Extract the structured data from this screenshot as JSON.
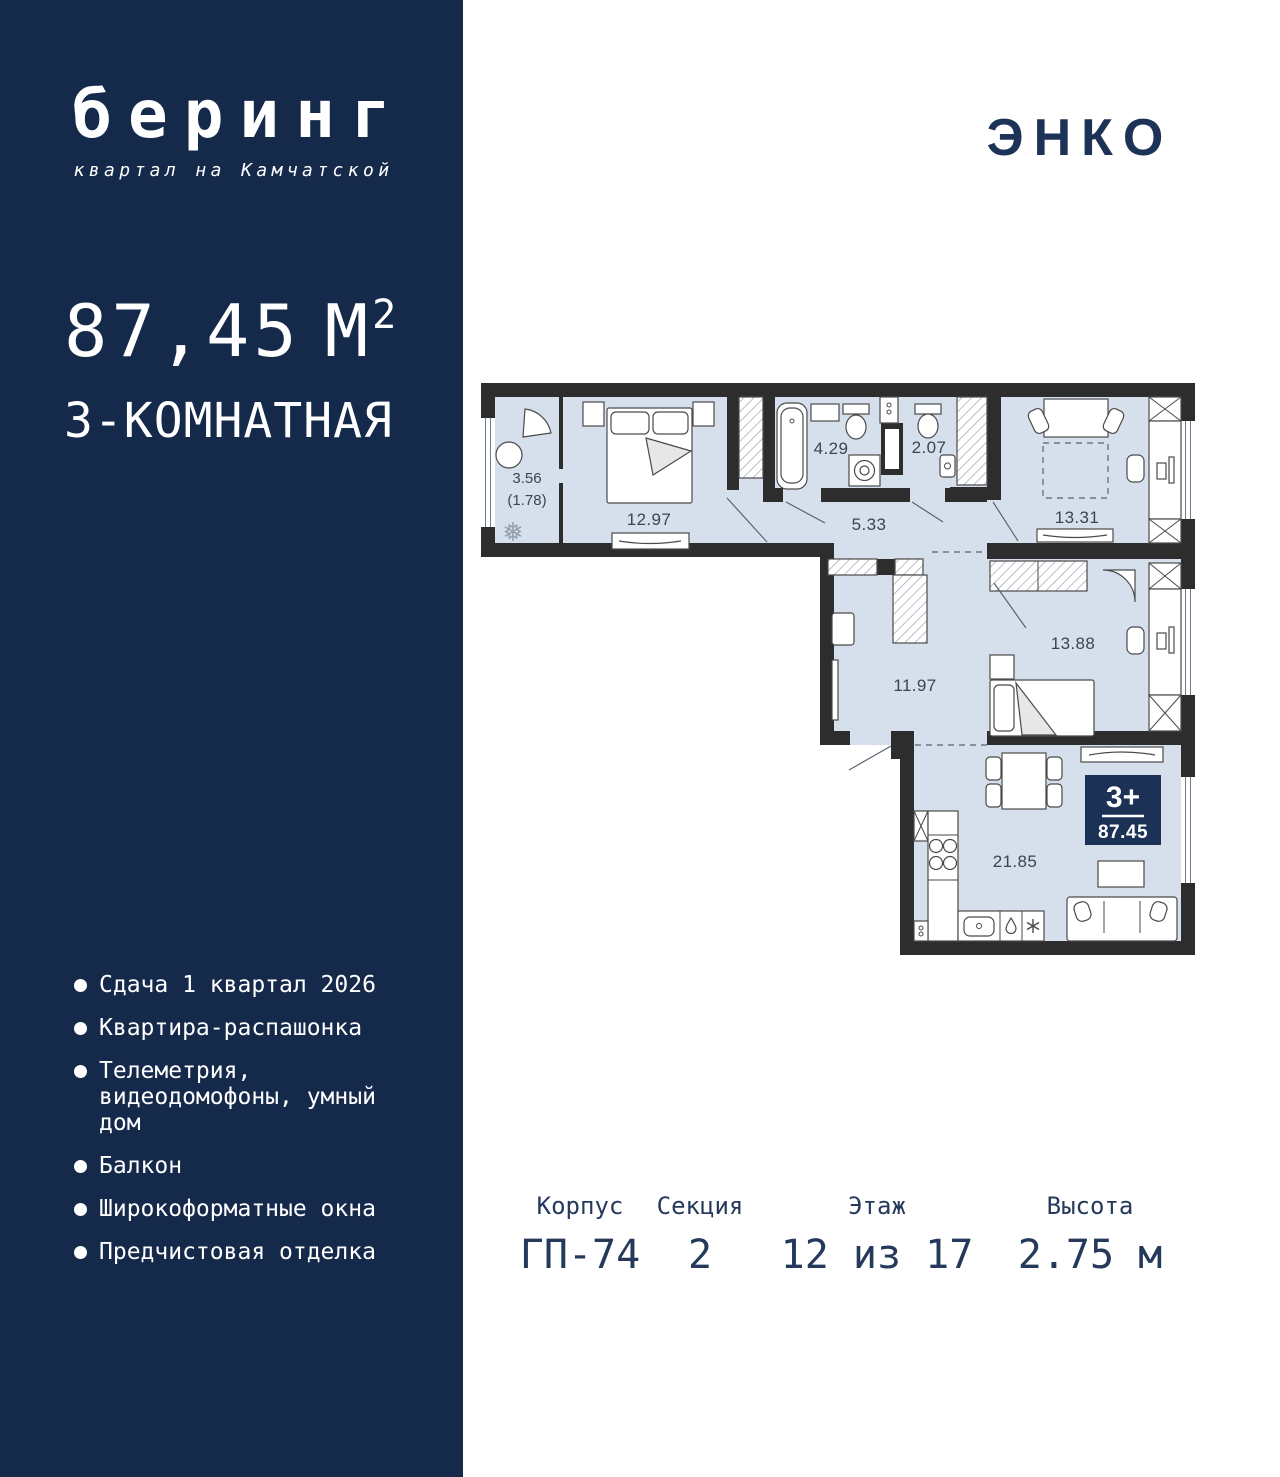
{
  "colors": {
    "navy": "#15294B",
    "badge": "#1C3156",
    "floor": "#D6E0EC",
    "wall": "#2D2D2D",
    "sumtext": "#25395B",
    "plabel": "#3B4552"
  },
  "sidebar": {
    "logo_title": "беринг",
    "logo_subtitle": "квартал на Камчатской",
    "area_value": "87,45",
    "area_unit": "М",
    "area_sup": "2",
    "rooms_title": "3-КОМНАТНАЯ",
    "features": [
      "Сдача 1 квартал 2026",
      "Квартира-распашонка",
      "Телеметрия, видеодомофоны, умный дом",
      "Балкон",
      "Широкоформатные окна",
      "Предчистовая отделка"
    ]
  },
  "developer": {
    "logo": "ЭНКО"
  },
  "plan": {
    "rooms": {
      "balcony": "3.56",
      "balcony_coeff": "(1.78)",
      "bedroom1": "12.97",
      "bathroom": "4.29",
      "wc": "2.07",
      "corridor": "5.33",
      "living": "13.31",
      "bedroom2": "13.88",
      "hall": "11.97",
      "kitchen": "21.85"
    },
    "badge": {
      "rooms": "3+",
      "area": "87.45"
    }
  },
  "summary": [
    {
      "label": "Корпус",
      "value": "ГП-74"
    },
    {
      "label": "Секция",
      "value": "2"
    },
    {
      "label": "Этаж",
      "value": "12 из 17"
    },
    {
      "label": "Высота",
      "value": "2.75 м"
    }
  ]
}
